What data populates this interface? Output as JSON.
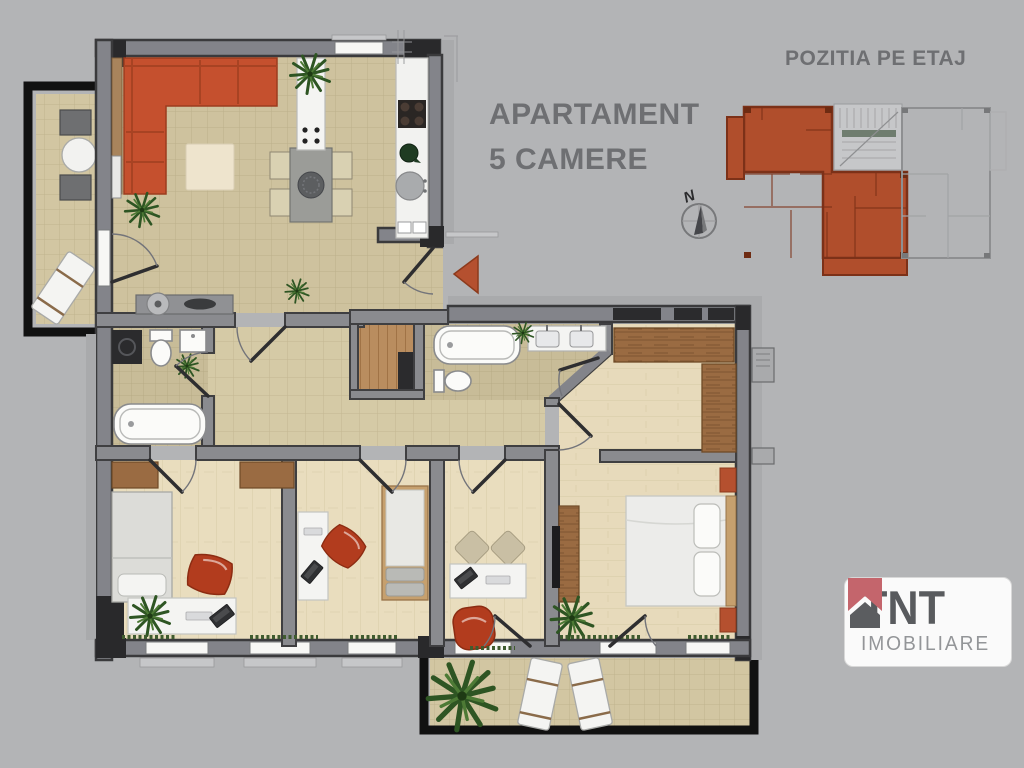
{
  "title": {
    "line1": "APARTAMENT",
    "line2": "5 CAMERE"
  },
  "minimap": {
    "label": "POZITIA PE ETAJ"
  },
  "compass": {
    "label": "N"
  },
  "logo": {
    "brand": "TNT",
    "subtitle": "IMOBILIARE"
  },
  "colors": {
    "background": "#b3b4b6",
    "wall_dark": "#3a3a3c",
    "wall_mid": "#83848a",
    "wall_light": "#a9aaac",
    "floor_tile": "#cec29e",
    "floor_hall": "#d5caa6",
    "floor_wood": "#e9ddbe",
    "wardrobe_wood": "#9a6b42",
    "sofa_orange": "#c5502e",
    "accent_terracotta": "#b04e2c",
    "minimap_unit_fill": "#b04e2c",
    "minimap_unit_wall": "#7c3118",
    "title_text": "#6e6f72",
    "logo_text": "#595b5e",
    "logo_subtext": "#939598",
    "logo_roof_pink": "#c4656c"
  },
  "icons": {
    "entrance_marker": "◀",
    "north_arrow": "↑N",
    "logo_house": "⌂"
  }
}
